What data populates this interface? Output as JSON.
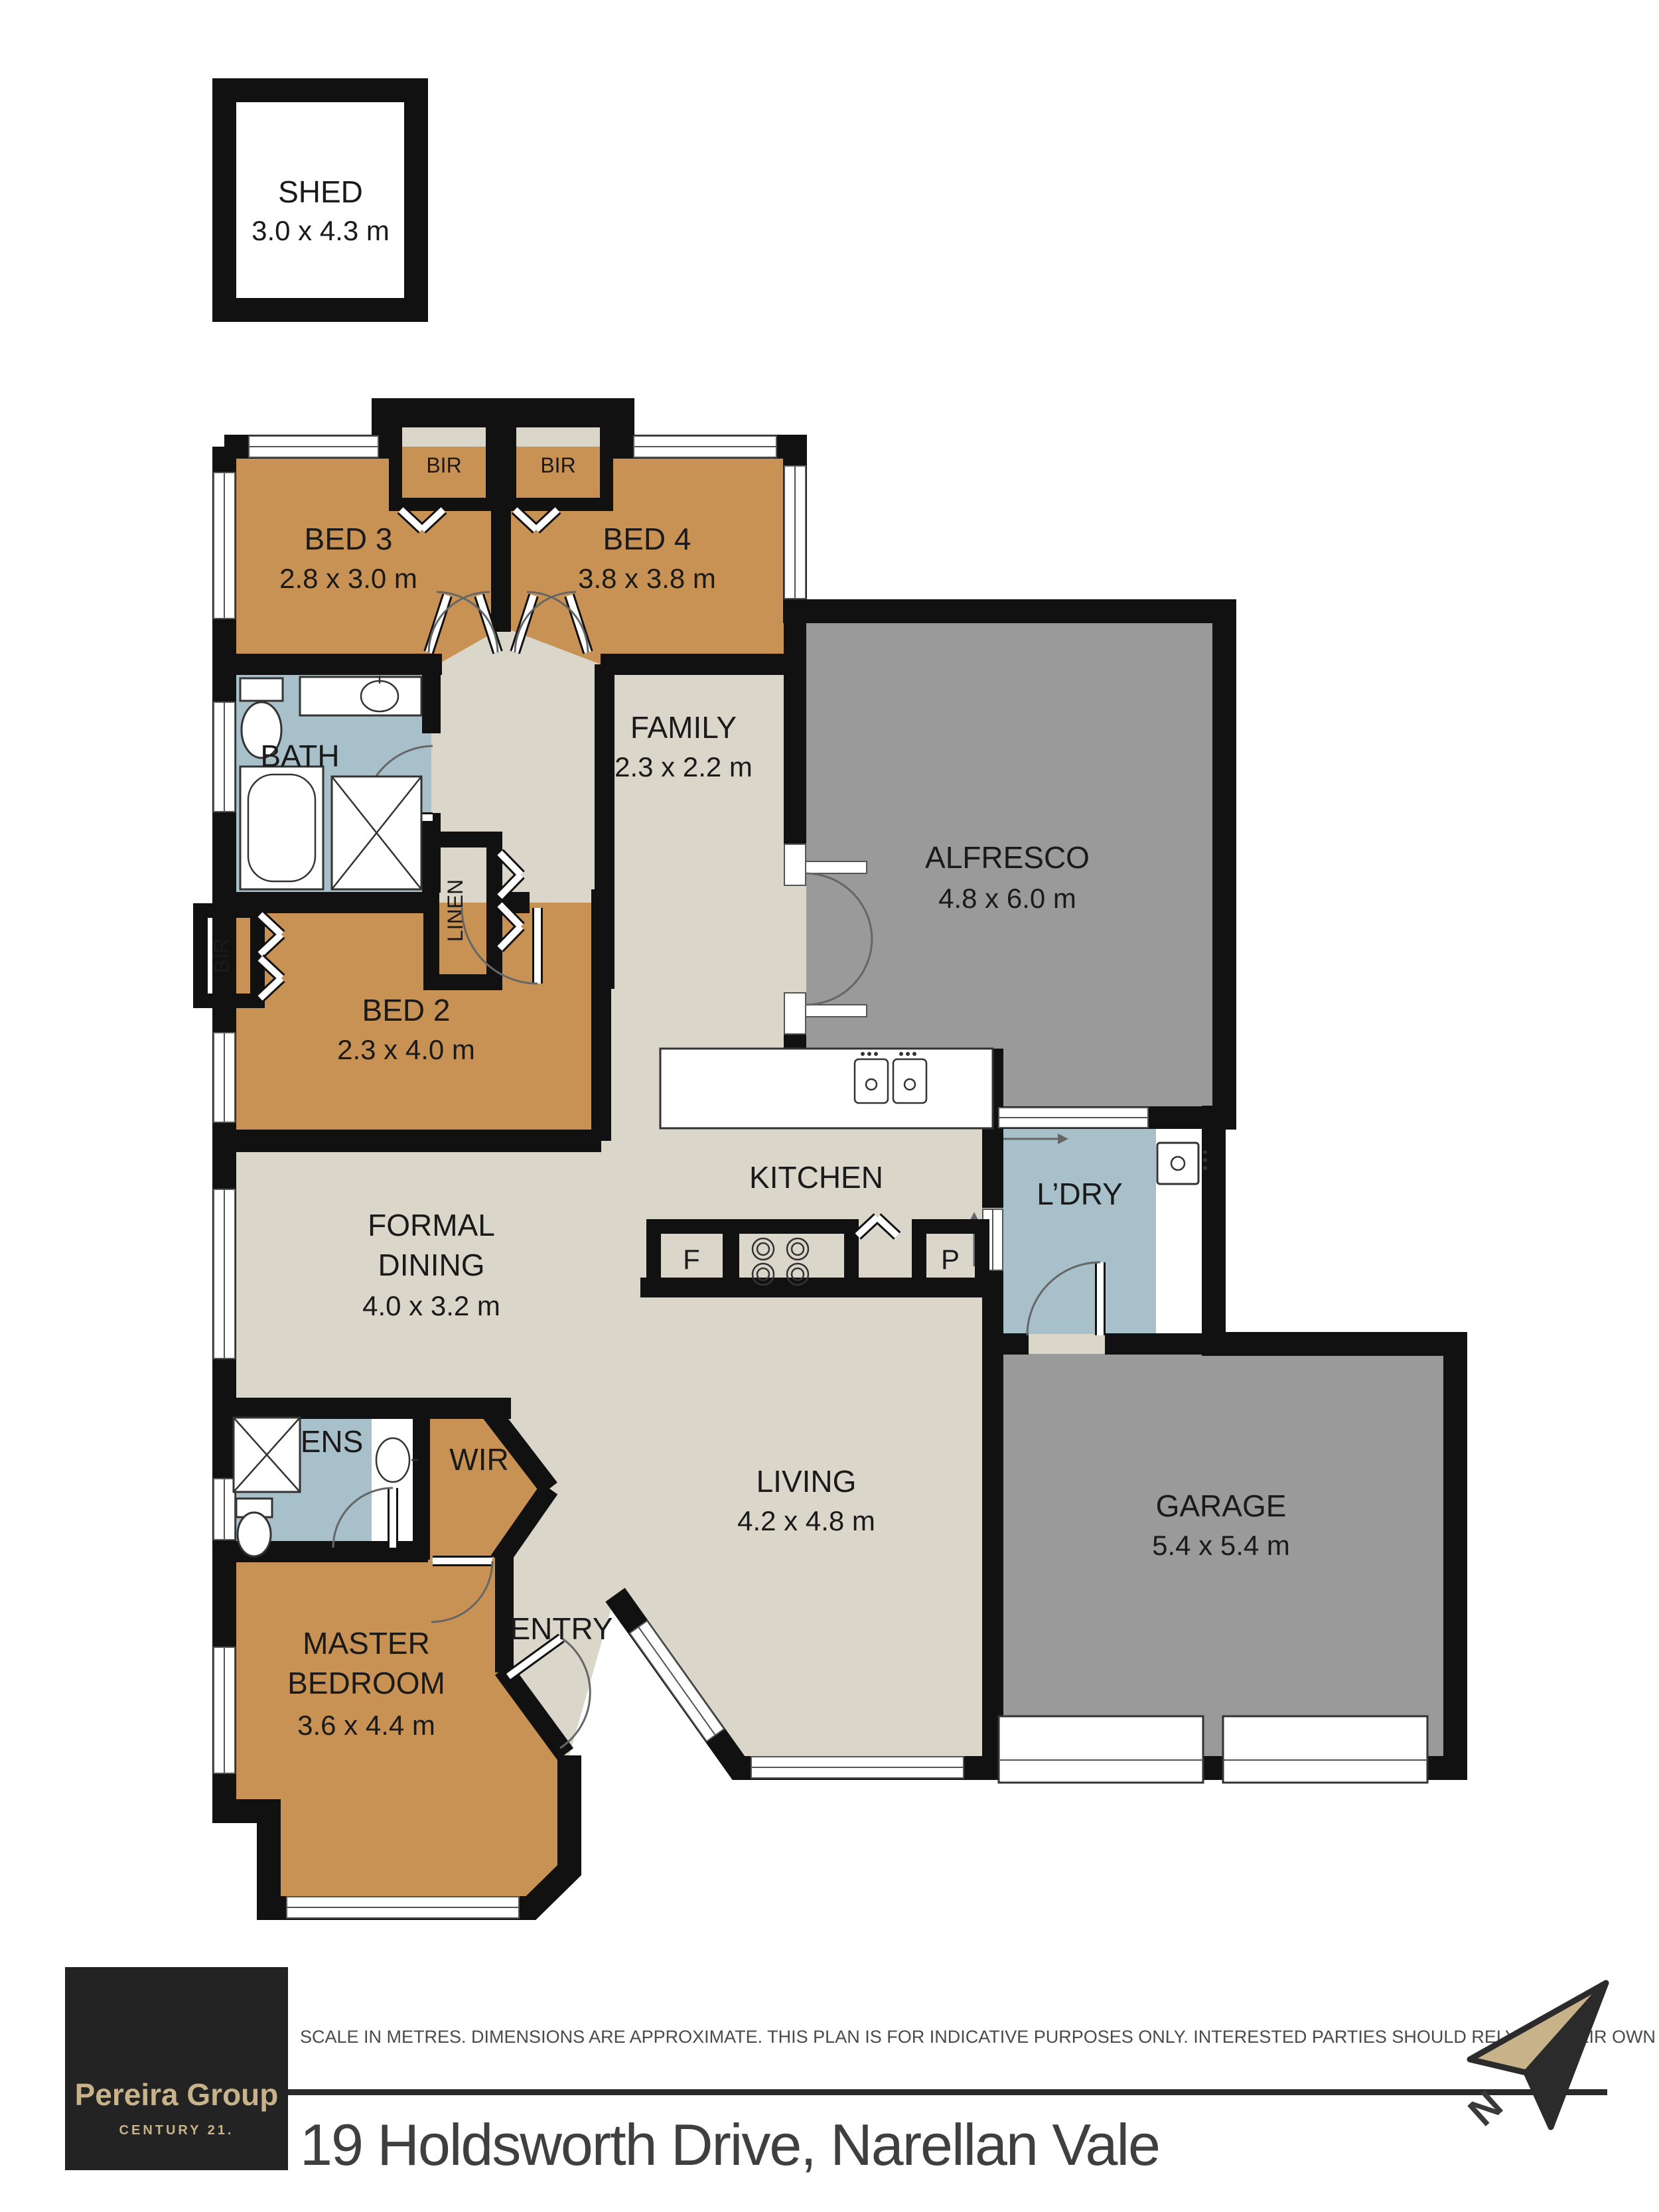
{
  "plan_title": "Floor plan",
  "rooms": {
    "shed": {
      "label": "SHED",
      "dims": "3.0 x 4.3 m"
    },
    "bed3": {
      "label": "BED 3",
      "dims": "2.8 x 3.0 m"
    },
    "bed4": {
      "label": "BED 4",
      "dims": "3.8 x 3.8 m"
    },
    "bath": {
      "label": "BATH"
    },
    "family": {
      "label": "FAMILY",
      "dims": "2.3 x 2.2 m"
    },
    "alfresco": {
      "label": "ALFRESCO",
      "dims": "4.8 x 6.0 m"
    },
    "bed2": {
      "label": "BED 2",
      "dims": "2.3 x 4.0 m"
    },
    "kitchen": {
      "label": "KITCHEN"
    },
    "laundry": {
      "label": "L’DRY"
    },
    "dining": {
      "line1": "FORMAL",
      "line2": "DINING",
      "dims": "4.0 x 3.2 m"
    },
    "living": {
      "label": "LIVING",
      "dims": "4.2 x 4.8 m"
    },
    "garage": {
      "label": "GARAGE",
      "dims": "5.4 x 5.4 m"
    },
    "ensuite": {
      "label": "ENS"
    },
    "wir": {
      "label": "WIR"
    },
    "entry": {
      "label": "ENTRY"
    },
    "master": {
      "line1": "MASTER",
      "line2": "BEDROOM",
      "dims": "3.6 x 4.4 m"
    }
  },
  "closets": {
    "bir_bed3": "BIR",
    "bir_bed4": "BIR",
    "bir_bed2": "BIR",
    "linen": "LINEN"
  },
  "appliances": {
    "fridge": "F",
    "pantry": "P"
  },
  "footer": {
    "logo_line1": "Pereira Group",
    "logo_line2": "CENTURY 21.",
    "disclaimer": "SCALE IN METRES. DIMENSIONS ARE APPROXIMATE. THIS PLAN IS FOR INDICATIVE PURPOSES ONLY. INTERESTED PARTIES SHOULD RELY ON THEIR OWN EXQUIRIES.",
    "address": "19 Holdsworth Drive, Narellan Vale",
    "north_letter": "N"
  },
  "colors": {
    "bedroom_tan": "#C89255",
    "wet_area_blue": "#A7C0CA",
    "outdoor_gray": "#9A9A9A",
    "floor_beige": "#DAD6CA",
    "wall_black": "#111111",
    "logo_bg": "#232323",
    "logo_gold": "#C8B28A"
  }
}
